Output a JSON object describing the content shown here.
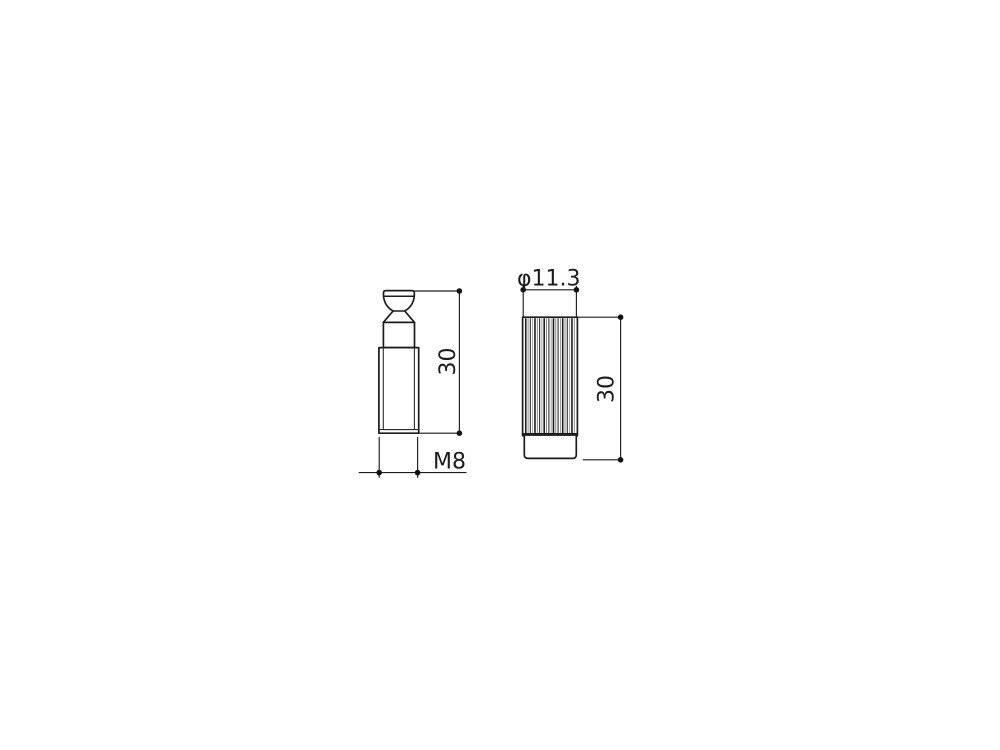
{
  "drawing": {
    "background_color": "#ffffff",
    "line_color": "#1c1c1c",
    "views": [
      {
        "id": "stud",
        "description": "threaded stud with domed head, side view"
      },
      {
        "id": "anchor",
        "description": "knurled anchor bushing, side view"
      }
    ],
    "anchor_knurl": {
      "line_count": 22
    }
  },
  "labels": {
    "stud_height": "30",
    "stud_thread": "M8",
    "anchor_diameter": "φ11.3",
    "anchor_height": "30"
  }
}
